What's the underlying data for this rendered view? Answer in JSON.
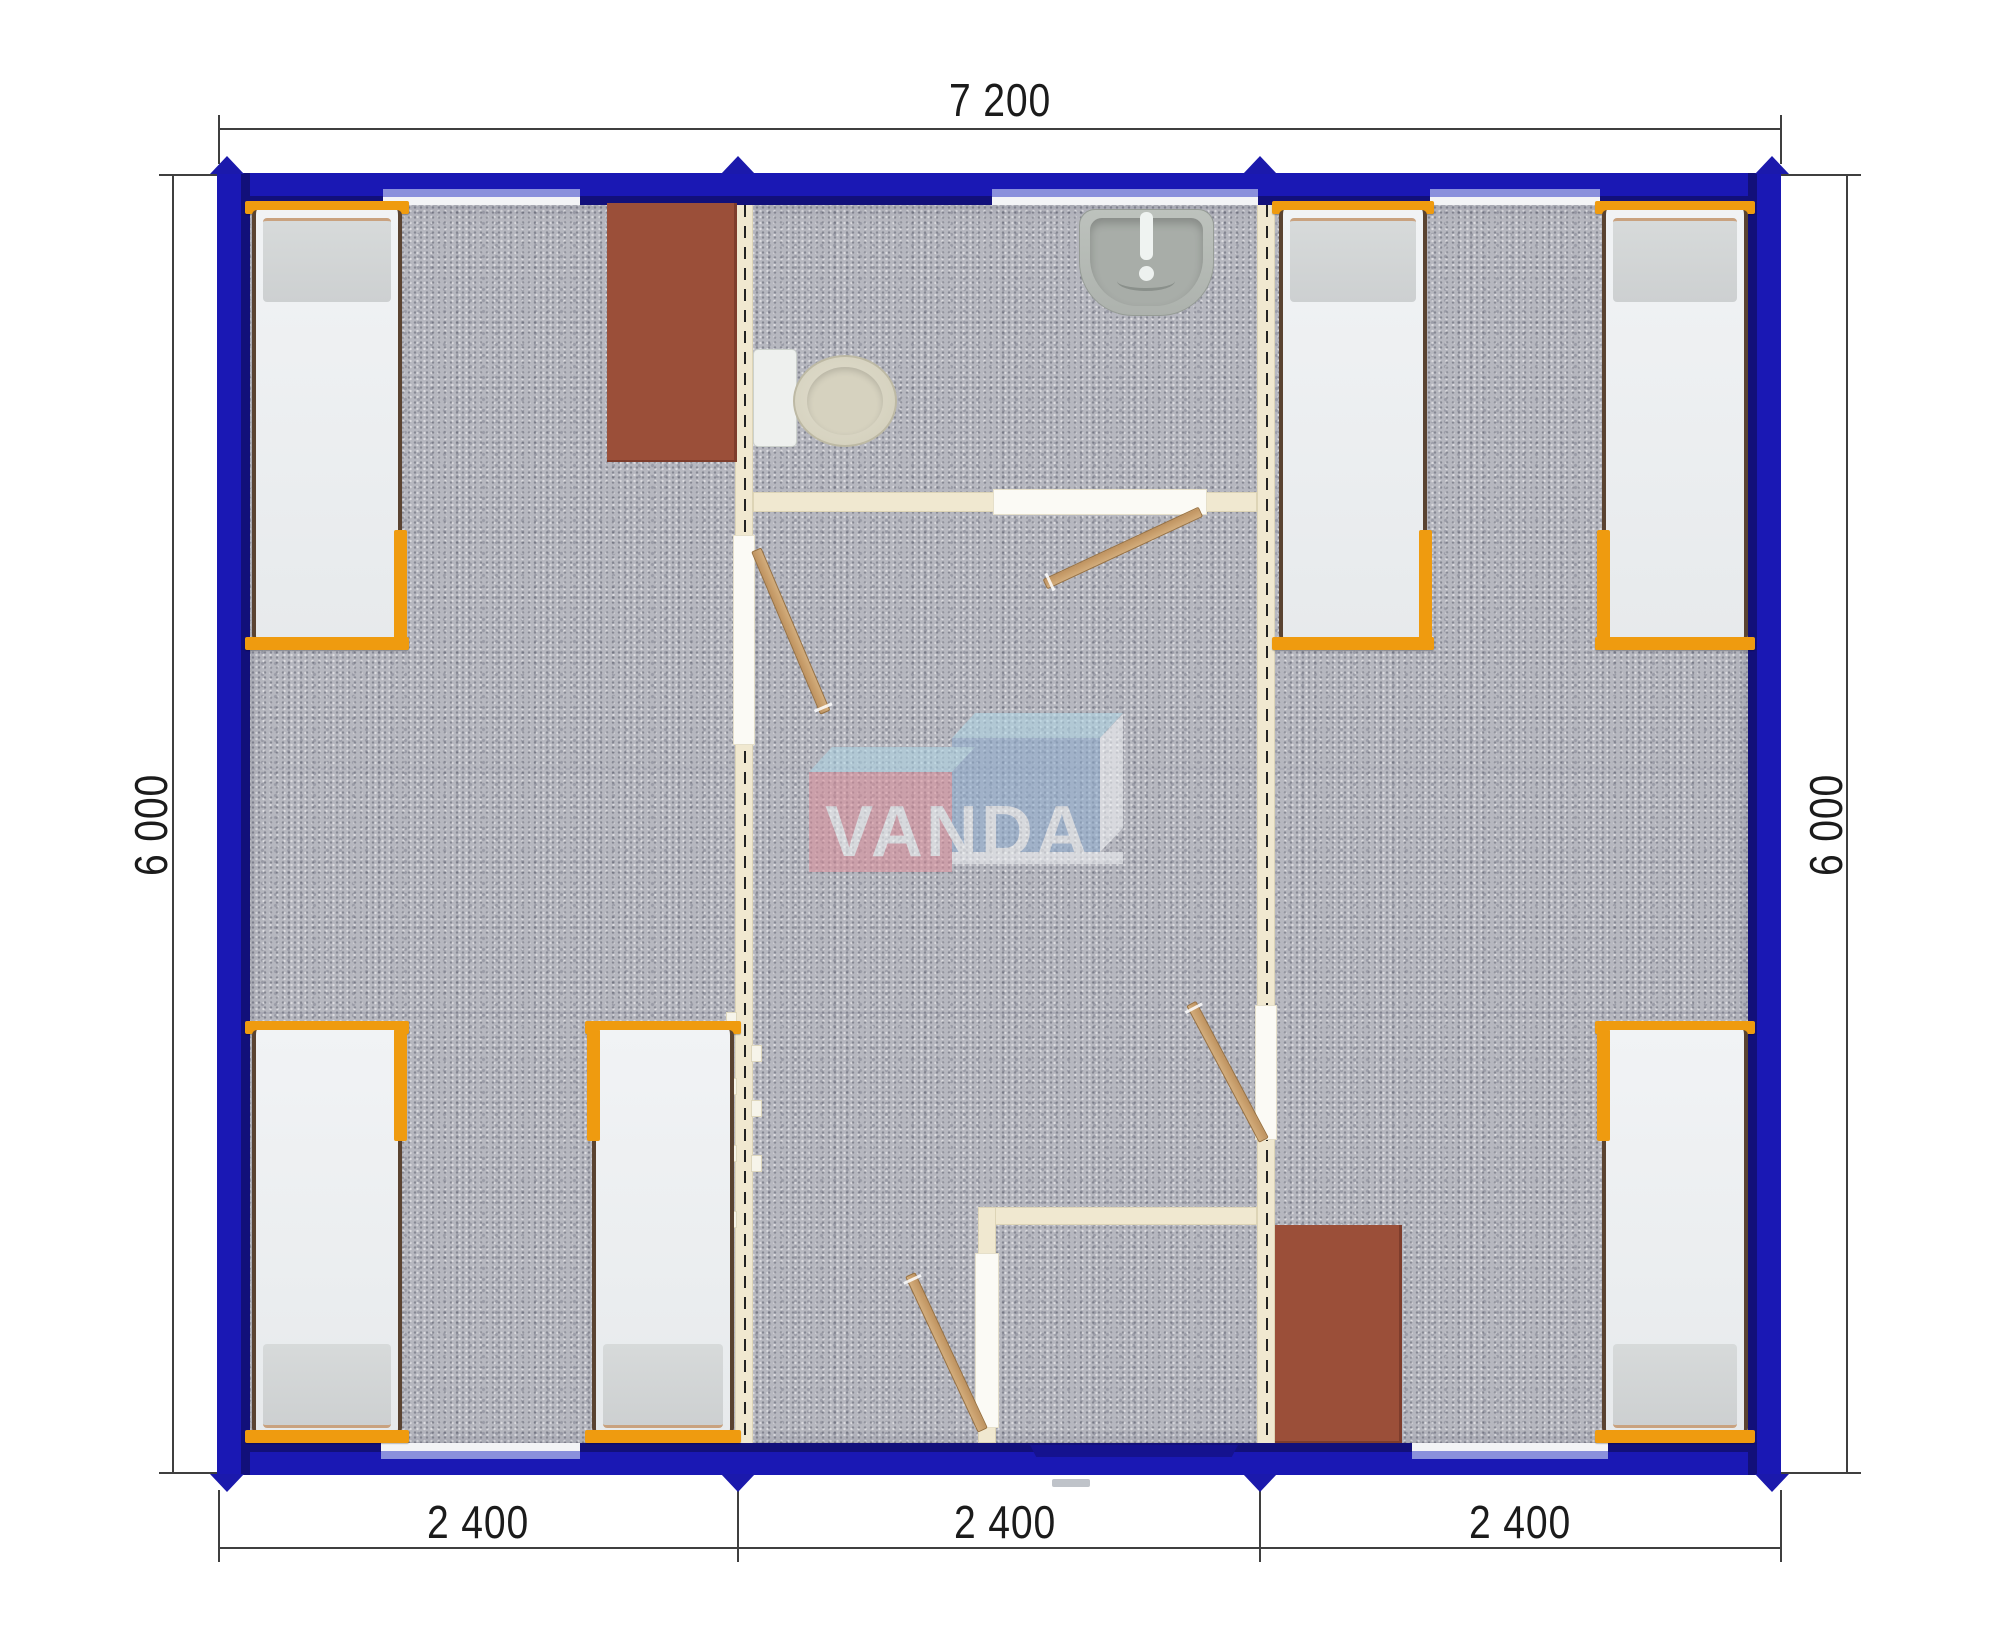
{
  "logo": {
    "text": "VANDA"
  },
  "dimensions": {
    "top_total": "7 200",
    "bottom_segments": [
      "2 400",
      "2 400",
      "2 400"
    ],
    "left_total": "6 000",
    "right_total": "6 000"
  },
  "furniture": {
    "beds": 6,
    "desks": 2,
    "toilets": 1,
    "sinks": 1,
    "interior_door_leaves": 4,
    "windows": 5,
    "entrance_doors": 1
  },
  "colors": {
    "wall": "#1a18b4",
    "walldark": "#12107a",
    "arrow": "#1b19ac",
    "carpet": "#b6b7bf",
    "partition": "#f0e8d0",
    "frame": "#ef9b0f",
    "bedside": "#5a4331",
    "desk": "#9b4f39",
    "glass": "#8a90dc",
    "dim": "#3f3f3f",
    "dimtext": "#1b1b1b",
    "logored": "#dc8f9b",
    "logoblue": "#8fadcf",
    "logotop": "#aed6e6"
  }
}
